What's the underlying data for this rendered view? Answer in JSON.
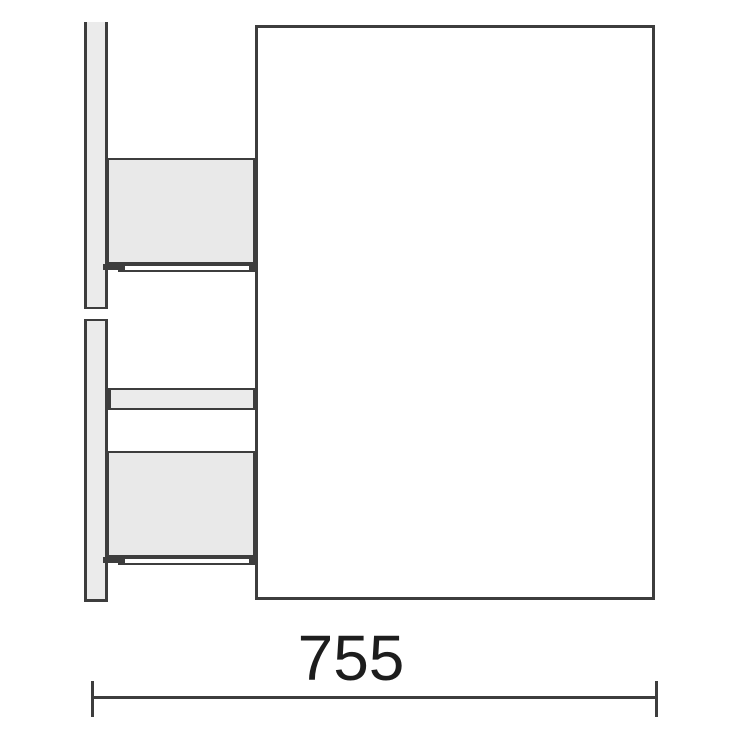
{
  "diagram": {
    "type": "furniture-technical-drawing-side-view",
    "parts": {
      "wall_panel": "broken vertical side panel (two segments with break gap)",
      "cabinet_body": "large rectangular carcass outline",
      "drawer_top": "upper drawer box with slide rail",
      "drawer_bottom": "lower drawer box with slide rail",
      "cross_rail": "horizontal rail between drawers"
    },
    "dimension": {
      "label": "755"
    },
    "colors": {
      "line": "#3d3d3d",
      "panel_fill": "#ebebeb",
      "drawer_fill": "#e9e9e9",
      "background": "#ffffff",
      "label_text": "#1d1d1d"
    }
  }
}
